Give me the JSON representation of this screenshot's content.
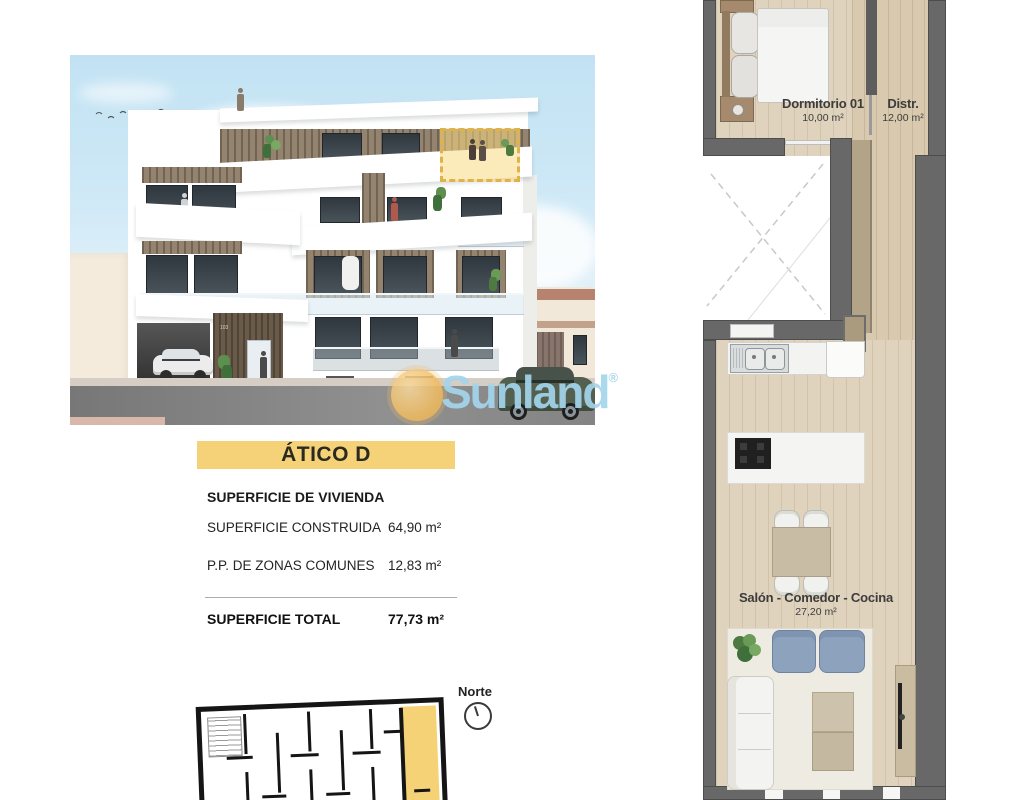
{
  "atico_panel": {
    "title": "ÁTICO D",
    "section_label": "SUPERFICIE DE VIVIENDA",
    "rows": [
      {
        "label": "SUPERFICIE CONSTRUIDA",
        "value": "64,90 m²"
      },
      {
        "label": "P.P. DE ZONAS COMUNES",
        "value": "12,83 m²"
      }
    ],
    "total_label": "SUPERFICIE TOTAL",
    "total_value": "77,73 m²"
  },
  "floorplan": {
    "rooms": [
      {
        "name": "Dormitorio 01",
        "area": "10,00 m²"
      },
      {
        "name": "Distr.",
        "area": "12,00 m²"
      },
      {
        "name": "Salón - Comedor - Cocina",
        "area": "27,20 m²"
      }
    ]
  },
  "keyplan": {
    "north_label": "Norte"
  },
  "render": {
    "building_number": "103"
  },
  "watermark": {
    "brand": "Sunland",
    "reg": "®"
  },
  "icons": {
    "birds": "flying-birds-icon",
    "north_compass": "north-compass-icon",
    "sun": "sun-logo-icon"
  },
  "colors": {
    "highlight_yellow": "#f5d277",
    "wall_gray": "#686868",
    "wood_floor": "#e0d3bd",
    "watermark_blue": "#a6d7ec",
    "sun_yellow": "#f1bd62",
    "keyplan_black": "#151515"
  }
}
